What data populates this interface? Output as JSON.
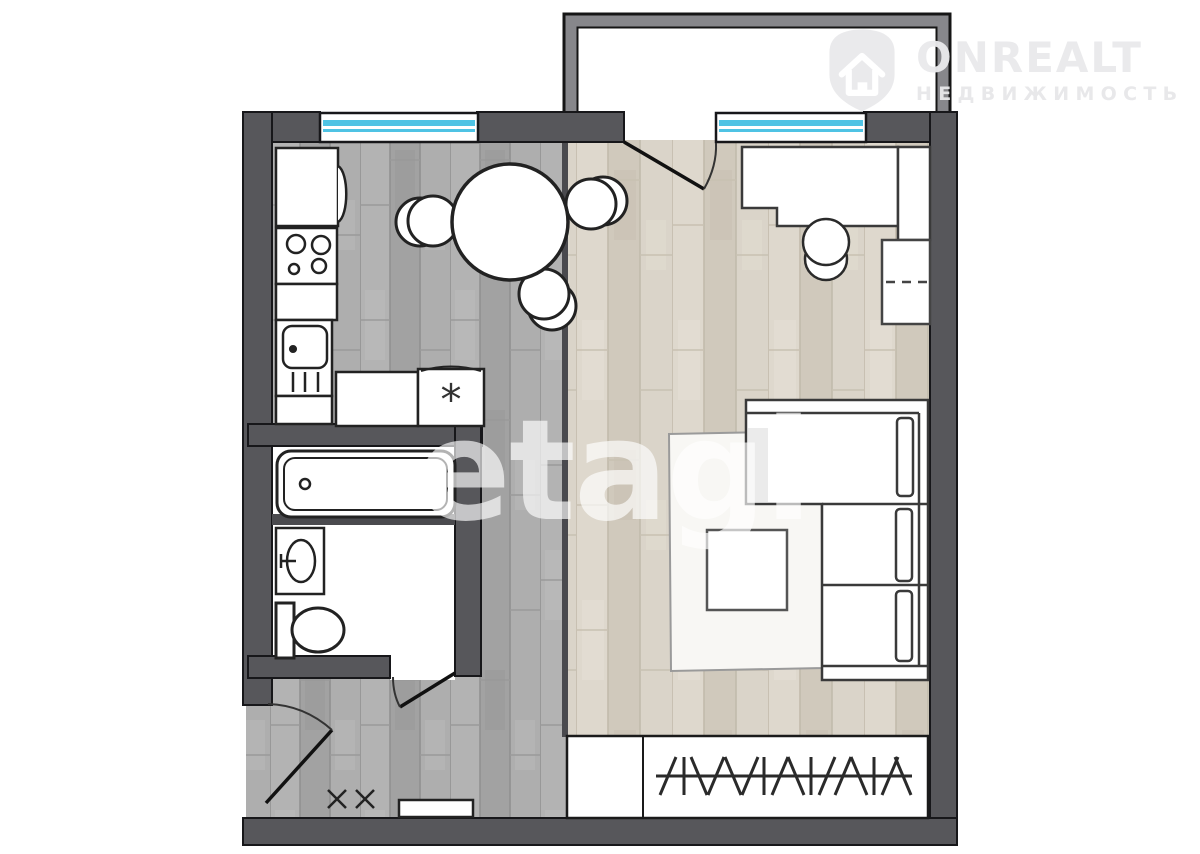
{
  "page": {
    "kind": "apartment floor plan (1-room flat), real-estate listing image",
    "background": "#ffffff"
  },
  "watermarks": {
    "etagi": {
      "text": "etagi"
    },
    "onrealt": {
      "brand": "ONREALT",
      "subtitle": "НЕДВИЖИМОСТЬ",
      "icon": "house-shield-icon"
    }
  },
  "plan": {
    "symbols": {
      "washing_machine_mark": "*"
    },
    "colors": {
      "wall": "#57575b",
      "interior_wall": "#4a4a4e",
      "balcony_rail": "#87878b",
      "window_glass": "#4fc3e4",
      "kitchen_hall_floor": "#aaaaaa",
      "living_room_floor": "#d7d1c6",
      "fixture_fill": "#ffffff",
      "fixture_outline": "#222222"
    },
    "rooms": [
      "kitchen",
      "living-room",
      "bathroom",
      "toilet-zone",
      "hallway",
      "balcony"
    ],
    "fixtures": [
      "fridge",
      "stove",
      "kitchen-sink",
      "countertop",
      "washing-machine",
      "dining-table",
      "dining-chairs",
      "bathtub",
      "washbasin",
      "toilet",
      "desk",
      "desk-chair",
      "shelf-cabinet",
      "corner-sofa",
      "rug",
      "coffee-table",
      "wardrobe-with-clothes-rail",
      "doormat"
    ]
  }
}
